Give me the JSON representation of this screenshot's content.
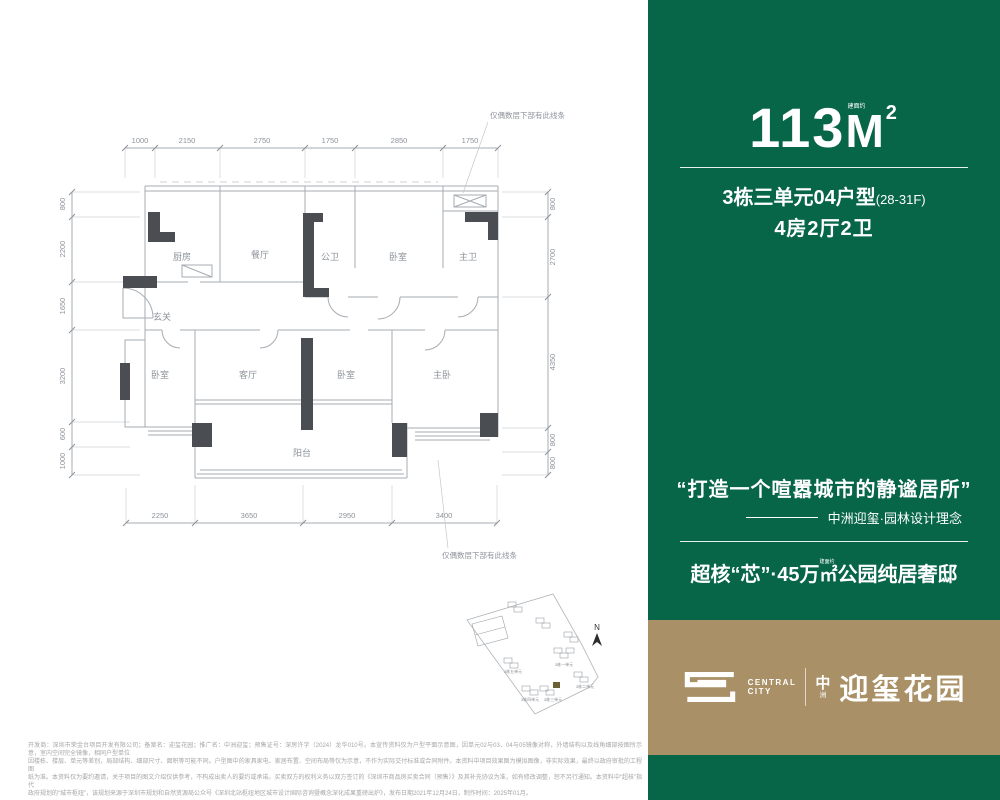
{
  "colors": {
    "green": "#076548",
    "tan": "#a99067",
    "wall_gray": "#4a4e53",
    "line_gray": "#a7acb2"
  },
  "right_panel": {
    "area": {
      "number": "113",
      "unit_letter": "M",
      "unit_sup": "2",
      "tiny_note": "建面约"
    },
    "unit_info": {
      "line1": "3栋三单元04户型",
      "floors": "(28-31F)",
      "line2": "4房2厅2卫"
    },
    "quote": "“打造一个喧嚣城市的静谧居所”",
    "quote_attribution": "中洲迎玺·园林设计理念",
    "slogan": {
      "pre": "超核“芯”·45万",
      "unit": "㎡",
      "unit_note": "建面约",
      "post": "公园纯居奢邸"
    },
    "logo": {
      "en1": "CENTRAL",
      "en2": "CITY",
      "cn_small_top": "中",
      "cn_small_bottom": "洲",
      "cn_big": "迎玺花园"
    }
  },
  "floor_plan": {
    "rooms": [
      "厨房",
      "餐厅",
      "公卫",
      "卧室",
      "主卫",
      "玄关",
      "卧室",
      "客厅",
      "卧室",
      "主卧",
      "阳台"
    ],
    "dims_top": [
      "1000",
      "2150",
      "2750",
      "1750",
      "2850",
      "1750"
    ],
    "dims_left": [
      "800",
      "2200",
      "1650",
      "3200",
      "600",
      "1000"
    ],
    "dims_right": [
      "800",
      "2700",
      "4350",
      "800",
      "800"
    ],
    "dims_bottom": [
      "2250",
      "3650",
      "2950",
      "3400"
    ],
    "note_top": "仅偶数层下部有此线条",
    "note_bottom": "仅偶数层下部有此线条"
  },
  "site_plan": {
    "north_label": "N",
    "building_labels": [
      "3栋一单元",
      "3栋二单元",
      "3栋三单元",
      "3栋四单元",
      "3栋五单元"
    ]
  },
  "disclaimer": {
    "line1": "开发商：深圳市荣金台项目开发有限公司；备案名：迎玺花园；推广名：中洲迎玺；预售证号：深房许字（2024）龙华010号。本宣传资料仅为户型平面示意图，因单元02与03、04与05镜像对称，外墙结构以及线角细部按图所示意，室内空间完全镜像，相同户型单位",
    "line2": "因楼栋、楼层、单元等差别，局部结构、细部尺寸、面积等可能不同。户型图中的家具家电、家居布置、空间布局等仅为示意，不作为实际交付标准或合同附件。本资料中项目效果图为模拟图像，非实际效果，最终以政府审批的工程图",
    "line3": "纸为准。本资料仅为要约邀请，关于项目的图文介绍仅供参考，不构成出卖人的要约或承诺。买卖双方的权利义务以双方签订的《深圳市商品房买卖合同（预售）》及其补充协议为准，如有修改调整，恕不另行通知。本资料中“超核”指代",
    "line4": "政府规划的“城市枢纽”，该规划来源于深圳市规划和自然资源局公众号《深圳北站枢纽地区城市设计国际咨询暨概念深化成果重磅出炉》，发布日期2021年12月24日，制作时间：2025年01月。"
  }
}
